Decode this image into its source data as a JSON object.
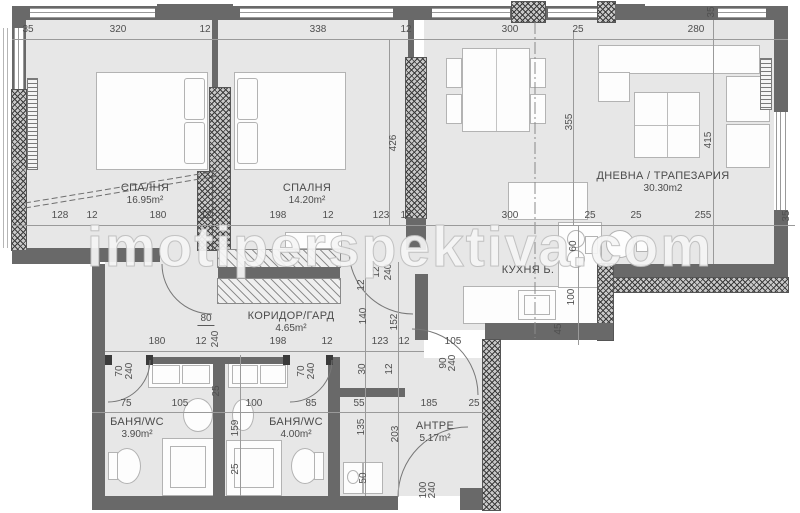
{
  "watermark": "imotiperspektiva.com",
  "rooms": [
    {
      "name": "СПАЛНЯ",
      "area": "16.95m²"
    },
    {
      "name": "СПАЛНЯ",
      "area": "14.20m²"
    },
    {
      "name": "ДНЕВНА / ТРАПЕЗАРИЯ",
      "area": "30.30m2"
    },
    {
      "name": "КУХНЯ Б.",
      "area": ""
    },
    {
      "name": "КОРИДОР/ГАРД",
      "area": "4.65m²"
    },
    {
      "name": "БАНЯ/WC",
      "area": "3.90m²"
    },
    {
      "name": "БАНЯ/WC",
      "area": "4.00m²"
    },
    {
      "name": "АНТРЕ",
      "area": "5.17m²"
    }
  ],
  "colors": {
    "wall": "#696969",
    "room_fill": "#e7e7e7",
    "dimension_text": "#4f4f4f",
    "label_text": "#4b4b4b"
  },
  "dimensions": [
    {
      "t": "35",
      "x": 28,
      "y": 30
    },
    {
      "t": "320",
      "x": 118,
      "y": 30
    },
    {
      "t": "12",
      "x": 205,
      "y": 30
    },
    {
      "t": "338",
      "x": 318,
      "y": 30
    },
    {
      "t": "12",
      "x": 406,
      "y": 30
    },
    {
      "t": "300",
      "x": 510,
      "y": 30
    },
    {
      "t": "25",
      "x": 578,
      "y": 30
    },
    {
      "t": "280",
      "x": 696,
      "y": 30
    },
    {
      "t": "35",
      "x": 712,
      "y": 12,
      "r": 1
    },
    {
      "t": "128",
      "x": 60,
      "y": 216
    },
    {
      "t": "12",
      "x": 92,
      "y": 216
    },
    {
      "t": "180",
      "x": 158,
      "y": 216
    },
    {
      "t": "12",
      "x": 206,
      "y": 216
    },
    {
      "t": "198",
      "x": 278,
      "y": 216
    },
    {
      "t": "12",
      "x": 328,
      "y": 216
    },
    {
      "t": "123",
      "x": 381,
      "y": 216
    },
    {
      "t": "12",
      "x": 406,
      "y": 216
    },
    {
      "t": "300",
      "x": 510,
      "y": 216
    },
    {
      "t": "25",
      "x": 590,
      "y": 216
    },
    {
      "t": "25",
      "x": 636,
      "y": 216
    },
    {
      "t": "255",
      "x": 703,
      "y": 216
    },
    {
      "t": "35",
      "x": 787,
      "y": 216,
      "r": 1
    },
    {
      "t": "426",
      "x": 394,
      "y": 143,
      "r": 1
    },
    {
      "t": "355",
      "x": 570,
      "y": 122,
      "r": 1
    },
    {
      "t": "415",
      "x": 709,
      "y": 140,
      "r": 1
    },
    {
      "t": "60",
      "x": 574,
      "y": 246,
      "r": 1
    },
    {
      "t": "100",
      "x": 572,
      "y": 297,
      "r": 1
    },
    {
      "t": "45",
      "x": 559,
      "y": 329,
      "r": 1
    },
    {
      "t": "180",
      "x": 157,
      "y": 342
    },
    {
      "t": "80",
      "x": 206,
      "y": 320,
      "u": 1
    },
    {
      "t": "12",
      "x": 201,
      "y": 342
    },
    {
      "t": "240",
      "x": 216,
      "y": 339,
      "r": 1
    },
    {
      "t": "198",
      "x": 278,
      "y": 342
    },
    {
      "t": "12",
      "x": 327,
      "y": 342
    },
    {
      "t": "123",
      "x": 380,
      "y": 342
    },
    {
      "t": "12",
      "x": 404,
      "y": 342
    },
    {
      "t": "105",
      "x": 453,
      "y": 342
    },
    {
      "t": "90",
      "x": 444,
      "y": 363,
      "r": 1
    },
    {
      "t": "240",
      "x": 453,
      "y": 363,
      "r": 1
    },
    {
      "t": "12",
      "x": 362,
      "y": 285,
      "r": 1
    },
    {
      "t": "12",
      "x": 377,
      "y": 272,
      "r": 1
    },
    {
      "t": "240",
      "x": 389,
      "y": 272,
      "r": 1
    },
    {
      "t": "140",
      "x": 364,
      "y": 316,
      "r": 1
    },
    {
      "t": "152",
      "x": 395,
      "y": 322,
      "r": 1
    },
    {
      "t": "30",
      "x": 363,
      "y": 369,
      "r": 1
    },
    {
      "t": "12",
      "x": 390,
      "y": 369,
      "r": 1
    },
    {
      "t": "70",
      "x": 120,
      "y": 371,
      "r": 1
    },
    {
      "t": "240",
      "x": 130,
      "y": 371,
      "r": 1
    },
    {
      "t": "70",
      "x": 302,
      "y": 371,
      "r": 1
    },
    {
      "t": "240",
      "x": 312,
      "y": 371,
      "r": 1
    },
    {
      "t": "25",
      "x": 217,
      "y": 391,
      "r": 1
    },
    {
      "t": "75",
      "x": 126,
      "y": 404
    },
    {
      "t": "105",
      "x": 180,
      "y": 404
    },
    {
      "t": "100",
      "x": 254,
      "y": 404
    },
    {
      "t": "85",
      "x": 311,
      "y": 404
    },
    {
      "t": "55",
      "x": 359,
      "y": 404
    },
    {
      "t": "185",
      "x": 429,
      "y": 404
    },
    {
      "t": "25",
      "x": 474,
      "y": 404
    },
    {
      "t": "159",
      "x": 236,
      "y": 428,
      "r": 1
    },
    {
      "t": "25",
      "x": 236,
      "y": 469,
      "r": 1
    },
    {
      "t": "135",
      "x": 362,
      "y": 427,
      "r": 1
    },
    {
      "t": "203",
      "x": 396,
      "y": 434,
      "r": 1
    },
    {
      "t": "50",
      "x": 364,
      "y": 478,
      "r": 1
    },
    {
      "t": "100",
      "x": 424,
      "y": 490,
      "r": 1
    },
    {
      "t": "240",
      "x": 433,
      "y": 490,
      "r": 1
    }
  ]
}
